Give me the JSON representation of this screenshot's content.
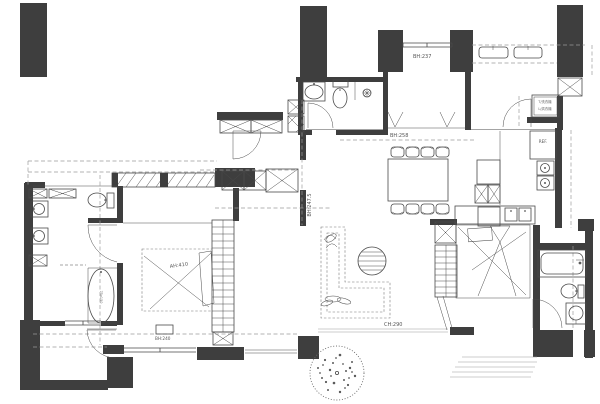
{
  "drawing": {
    "type": "apartment-floor-plan",
    "labels": {
      "top_bedroom_height": "BH:237",
      "dining_height": "BH:258",
      "corridor_height": "BH:247.5",
      "master_bed": "AH:410",
      "master_cabinet_height": "BH:240",
      "living_height": "CH:290",
      "fridge": "REF.",
      "washer": "T/洗衣機",
      "dryer": "L/烘衣機",
      "bathtub_size": "75x150"
    },
    "colors": {
      "background": "#ffffff",
      "wall": "#3e3e3e",
      "line": "#4a4a4a",
      "light_line": "#9a9a9a",
      "dashed_line": "#9b9b9b"
    }
  }
}
